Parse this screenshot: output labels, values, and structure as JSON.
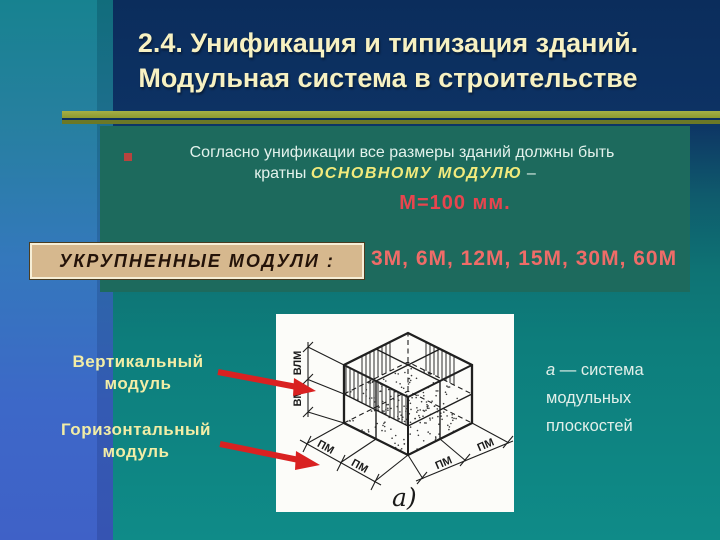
{
  "slide": {
    "title_line1": "2.4. Унификация и типизация зданий.",
    "title_line2": "Модульная система в строительстве",
    "bullet": {
      "line1": "Согласно унификации все размеры зданий должны быть",
      "line2_prefix": "кратны ",
      "line2_em": "ОСНОВНОМУ МОДУЛЮ",
      "line2_suffix": " –",
      "value": "М=100 мм."
    },
    "modules": {
      "box_label": "УКРУПНЕННЫЕ МОДУЛИ :",
      "values": "3М, 6М, 12М, 15М, 30М, 60М"
    },
    "labels": {
      "vertical_line1": "Вертикальный",
      "vertical_line2": "модуль",
      "horizontal_line1": "Горизонтальный",
      "horizontal_line2": "модуль"
    },
    "caption": {
      "a_label": "а",
      "line1_rest": " — система",
      "line2": "модульных",
      "line3": "плоскостей"
    },
    "diagram": {
      "dim_vertical_top": "ВЛМ",
      "dim_vertical_bottom": "ВМ",
      "dim_pm": "ПМ",
      "sub_label": "а)"
    },
    "colors": {
      "title_text": "#f7f1c2",
      "panel_green": "#1d6a5d",
      "accent_yellow": "#f2ea7c",
      "accent_red": "#e8454e",
      "modules_salmon": "#ef6c68",
      "box_tan": "#d6b88e",
      "arrow_red": "#d92121",
      "strip_teal_top": "#178290",
      "strip_blue_bottom": "#3f61c7"
    }
  }
}
